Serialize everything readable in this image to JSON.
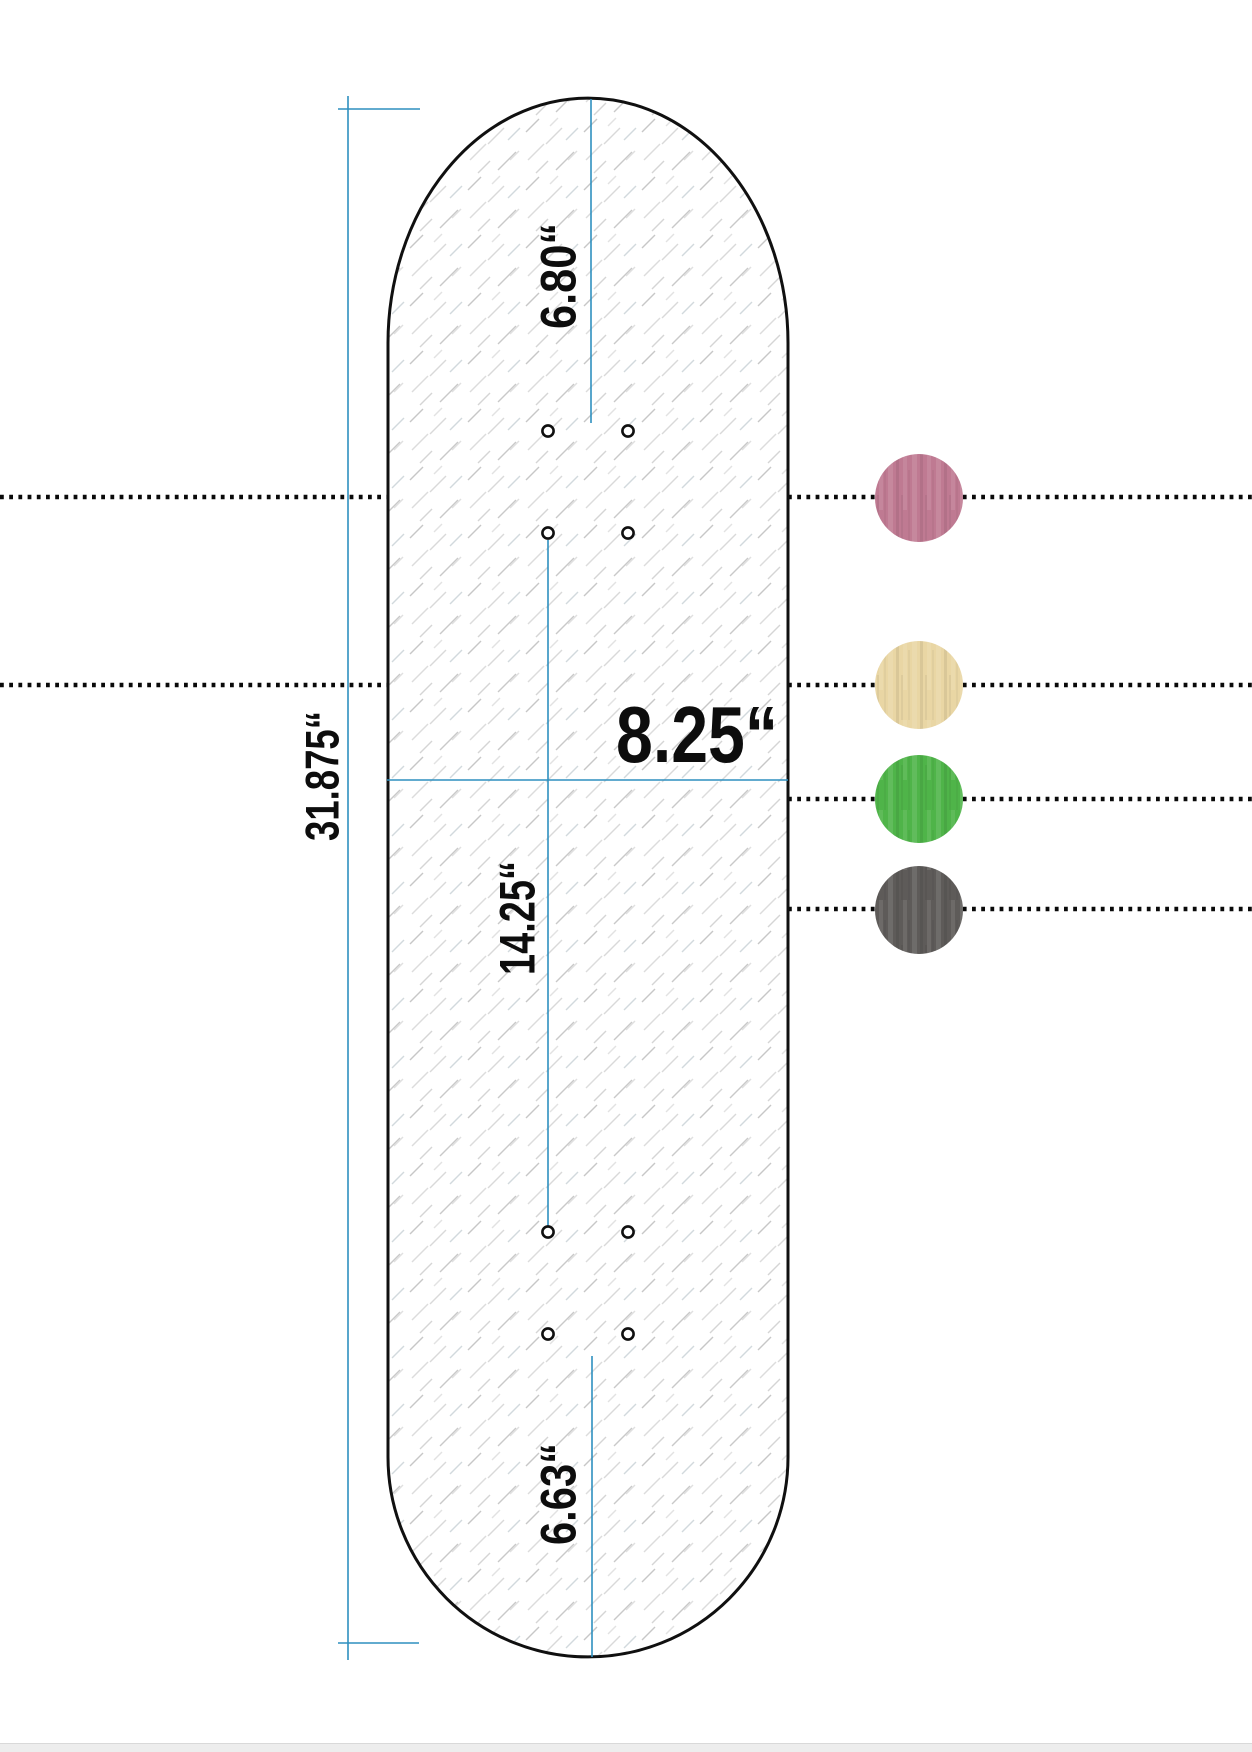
{
  "page": {
    "background": "#ffffff",
    "footer_strip_color": "#ededed"
  },
  "diagram": {
    "accent_color": "#2e8fbf",
    "outline_color": "#101010",
    "guide_dot_color": "#0a0a0a",
    "labels": {
      "total_length": "31.875“",
      "width": "8.25“",
      "nose": "6.80“",
      "wheelbase": "14.25“",
      "tail": "6.63“"
    }
  },
  "swatches": [
    {
      "color": "#bf7a92"
    },
    {
      "color": "#e9d6a4"
    },
    {
      "color": "#4fb449"
    },
    {
      "color": "#5e5b59"
    }
  ]
}
